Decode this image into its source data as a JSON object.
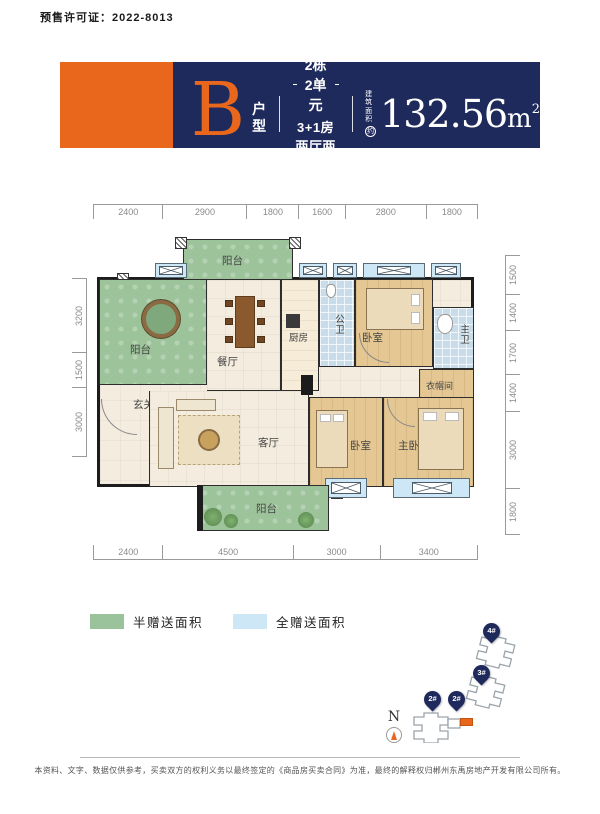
{
  "permit_text": "预售许可证：2022-8013",
  "banner": {
    "type_letter": "B",
    "type_label": "户型",
    "unit_line1": "2栋2单元",
    "unit_line2": "3+1房两厅两卫",
    "area_label_top": "建筑",
    "area_label_bottom": "面积",
    "area_circle_char": "约",
    "area_value": "132.56",
    "area_unit_base": "m",
    "area_unit_sup": "2",
    "accent_orange": "#E8671C",
    "navy": "#1F2A5C"
  },
  "floorplan": {
    "dims_top": [
      "2400",
      "2900",
      "1800",
      "1600",
      "2800",
      "1800"
    ],
    "dims_bottom": [
      "2400",
      "4500",
      "3000",
      "3400"
    ],
    "dims_left": [
      "3200",
      "1500",
      "3000"
    ],
    "dims_right": [
      "1500",
      "1400",
      "1700",
      "1400",
      "3000",
      "1800"
    ],
    "rooms": {
      "balcony_top": "阳台",
      "balcony_left": "阳台",
      "dining": "餐厅",
      "kitchen": "厨房",
      "bath_public": "公卫",
      "bedroom_top": "卧室",
      "bath_master": "主卫",
      "closet": "衣帽间",
      "entry": "玄关",
      "living": "客厅",
      "bedroom_mid": "卧室",
      "bedroom_master": "主卧",
      "balcony_bottom": "阳台"
    }
  },
  "legend": {
    "items": [
      {
        "label": "半赠送面积",
        "color": "#9BC39B"
      },
      {
        "label": "全赠送面积",
        "color": "#CDE7F6"
      }
    ]
  },
  "siteplan": {
    "north_label": "N",
    "pins": [
      {
        "label": "4#"
      },
      {
        "label": "3#"
      },
      {
        "label": "2#"
      },
      {
        "label": "2#"
      }
    ]
  },
  "footer": {
    "disclaimer": "本资料、文字、数据仅供参考，买卖双方的权利义务以最终签定的《商品房买卖合同》为准，最终的解释权归郴州东禹房地产开发有限公司所有。"
  }
}
